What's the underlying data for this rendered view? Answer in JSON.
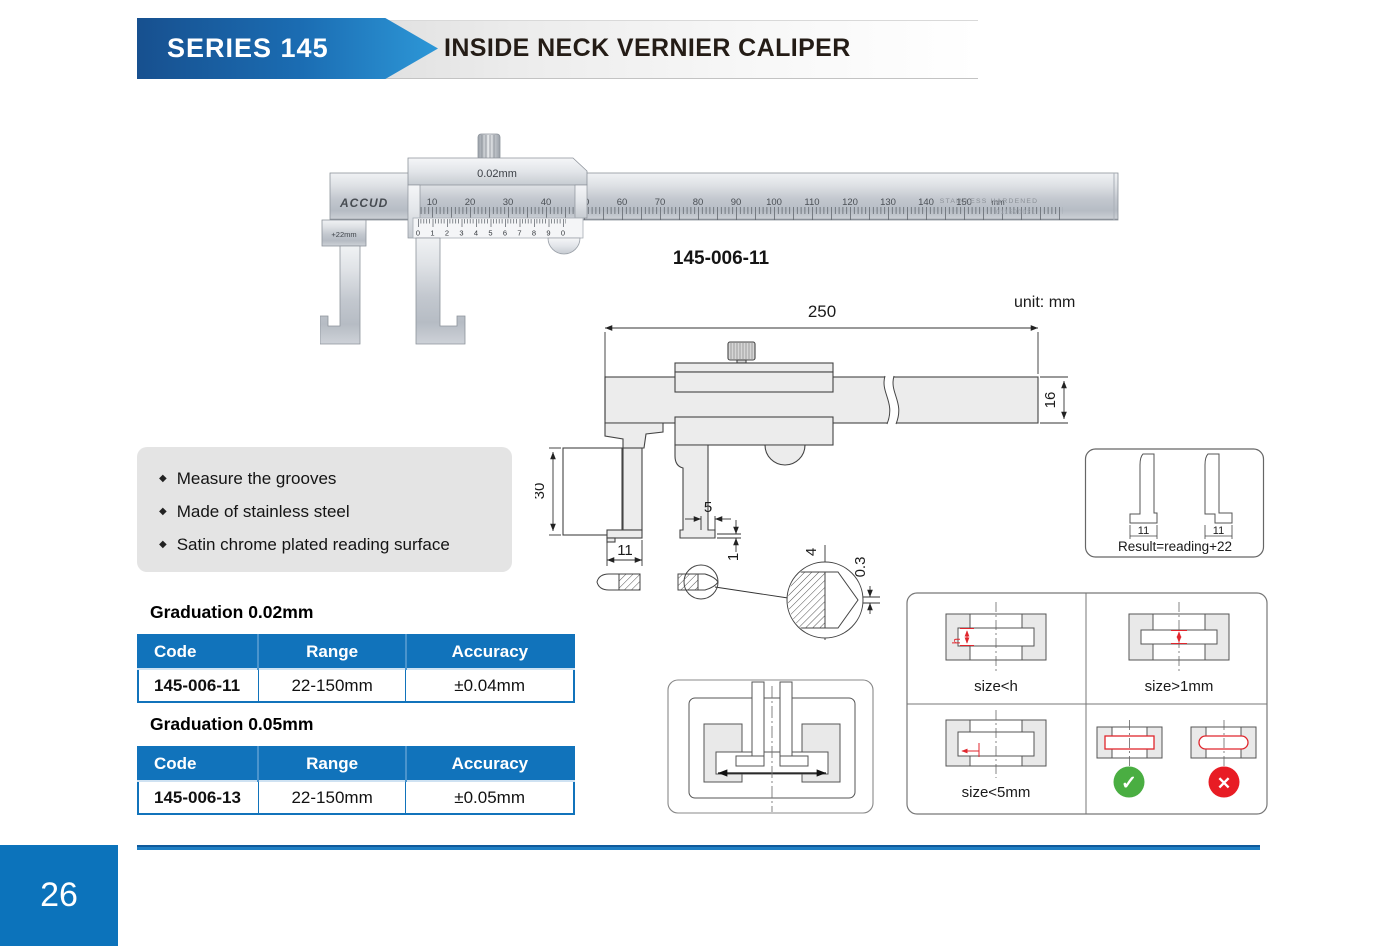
{
  "header": {
    "series_label": "SERIES 145",
    "title": "INSIDE NECK VERNIER CALIPER"
  },
  "caliper_photo": {
    "brand": "ACCUD",
    "slider_graduation": "0.02mm",
    "jaw_offset_label": "+22mm",
    "main_scale": [
      "10",
      "20",
      "30",
      "40",
      "50",
      "60",
      "70",
      "80",
      "90",
      "100",
      "110",
      "120",
      "130",
      "140",
      "150"
    ],
    "main_scale_unit": "mm",
    "vernier_scale": [
      "0",
      "1",
      "2",
      "3",
      "4",
      "5",
      "6",
      "7",
      "8",
      "9",
      "0"
    ],
    "stamp_text": "STAINLESS  HARDENED",
    "stamp_serial": "011590031",
    "model": "145-006-11"
  },
  "drawing": {
    "unit_label": "unit: mm",
    "dim_total_length": "250",
    "dim_beam_height": "16",
    "dim_jaw_reach": "30",
    "dim_foot_length": "11",
    "dim_tip_width": "5",
    "dim_tip_thickness": "1",
    "dim_tip_height": "4",
    "dim_tip_edge": "0.3"
  },
  "features": {
    "bullet_glyph": "◆",
    "items": [
      "Measure the grooves",
      "Made of stainless steel",
      "Satin chrome plated reading surface"
    ]
  },
  "spec_sections": [
    {
      "heading": "Graduation 0.02mm",
      "columns": [
        "Code",
        "Range",
        "Accuracy"
      ],
      "row": {
        "code": "145-006-11",
        "range": "22-150mm",
        "accuracy": "±0.04mm"
      }
    },
    {
      "heading": "Graduation 0.05mm",
      "columns": [
        "Code",
        "Range",
        "Accuracy"
      ],
      "row": {
        "code": "145-006-13",
        "range": "22-150mm",
        "accuracy": "±0.05mm"
      }
    }
  ],
  "result_box": {
    "left_dim": "11",
    "right_dim": "11",
    "caption": "Result=reading+22"
  },
  "usage_grid": {
    "cells": [
      {
        "caption": "size<h",
        "dim_label": "h"
      },
      {
        "caption": "size>1mm"
      },
      {
        "caption": "size<5mm"
      },
      {
        "caption": ""
      }
    ],
    "icons": {
      "check_glyph": "✓",
      "cross_glyph": "✕"
    }
  },
  "footer": {
    "page_number": "26"
  },
  "colors": {
    "accent_blue": "#1173bb",
    "header_arrow_dark": "#17508f",
    "header_arrow_light": "#2d97d7",
    "table_header_bg": "#1173bb",
    "check_green": "#4aae42",
    "cross_red": "#e81c24",
    "dim_red": "#e0262d",
    "footer_bar_blue": "#1f7fc4",
    "page_box_blue": "#0c73bb"
  }
}
